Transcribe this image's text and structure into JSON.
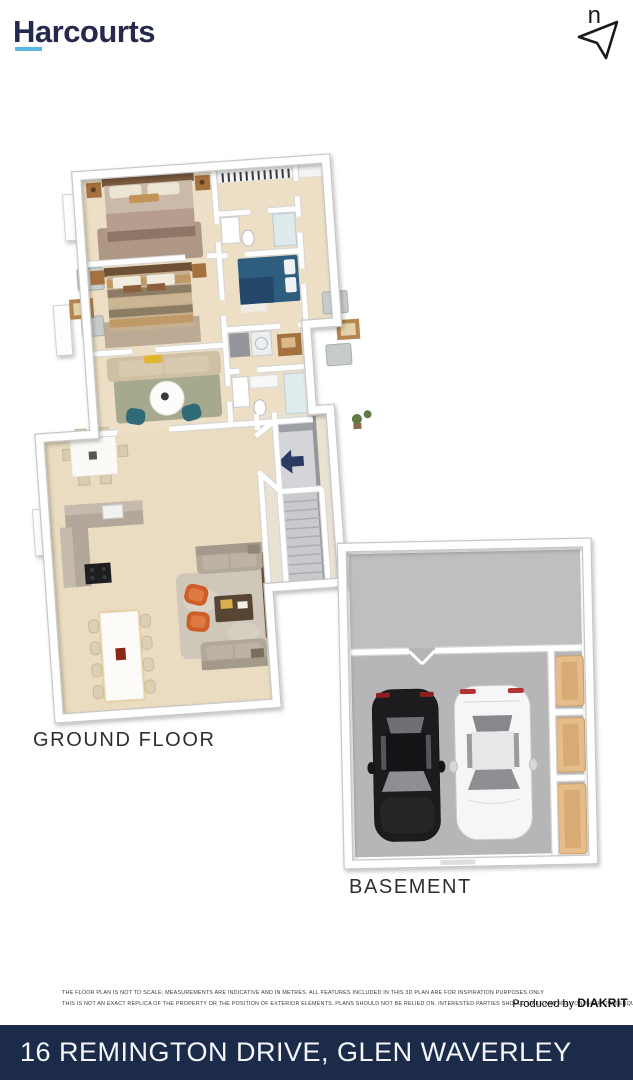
{
  "header": {
    "logo_text": "Harcourts",
    "north_label": "n"
  },
  "plans": {
    "ground": {
      "label": "GROUND FLOOR"
    },
    "basement": {
      "label": "BASEMENT"
    }
  },
  "footer": {
    "disclaimer_line1": "THE FLOOR PLAN IS NOT TO SCALE; MEASUREMENTS ARE INDICATIVE AND IN METRES. ALL FEATURES INCLUDED IN THIS 3D PLAN ARE FOR INSPIRATION PURPOSES ONLY",
    "disclaimer_line2": "THIS IS NOT AN EXACT REPLICA OF THE PROPERTY OR THE POSITION OF EXTERIOR ELEMENTS. PLANS SHOULD NOT BE RELIED ON. INTERESTED PARTIES SHOULD MAKE AND RELY ON THEIR OWN ENQUIRIES.",
    "produced_by": "Produced by",
    "producer": "DIAKRIT",
    "address": "16 REMINGTON DRIVE, GLEN WAVERLEY"
  },
  "colors": {
    "harcourts_navy": "#232a4d",
    "harcourts_blue": "#59b7e3",
    "footer_bar_navy": "#1d2b4a",
    "floor_beige": "#ecdfc5",
    "basement_gray": "#b6b6b8",
    "entry_arrow_navy": "#2b3a63",
    "wall_white": "#ffffff"
  }
}
